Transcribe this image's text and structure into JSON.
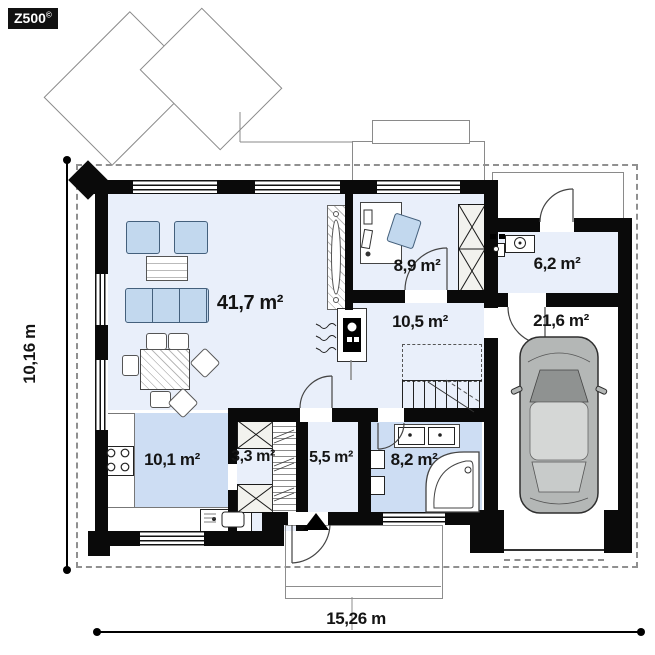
{
  "logo": {
    "text": "Z500",
    "mark": "©"
  },
  "dimensions": {
    "height_label": "10,16 m",
    "width_label": "15,26 m"
  },
  "rooms": [
    {
      "name": "living-room",
      "area": "41,7 m²"
    },
    {
      "name": "office",
      "area": "8,9 m²"
    },
    {
      "name": "utility-room",
      "area": "6,2 m²"
    },
    {
      "name": "hall",
      "area": "10,5 m²"
    },
    {
      "name": "garage",
      "area": "21,6 m²"
    },
    {
      "name": "kitchen",
      "area": "10,1 m²"
    },
    {
      "name": "pantry",
      "area": "3,3 m²"
    },
    {
      "name": "entry-hall",
      "area": "5,5 m²"
    },
    {
      "name": "bathroom",
      "area": "8,2 m²"
    }
  ],
  "symbols": {
    "entrance_arrow": "filled-triangle-up"
  },
  "colors": {
    "wall": "#0a0a0a",
    "floor_light": "#e9effa",
    "floor_blue": "#cdddf3",
    "furniture_blue": "#c2d8ee",
    "car_gray": "#b4b7b6",
    "roof_outline_dashed": "#909090"
  }
}
